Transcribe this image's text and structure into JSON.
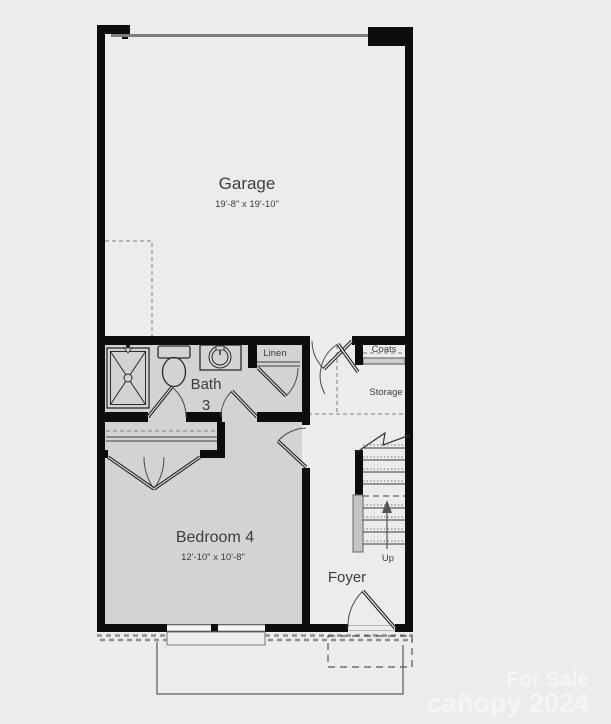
{
  "plan_title": "First floor plan",
  "colors": {
    "background": "#ececec",
    "wall": "#0d0d0d",
    "floor_gray": "#d3d3d3",
    "garage_door_line": "#7d7d7d",
    "label_text": "#3d3d3d",
    "watermark_text": "#f5f5f5"
  },
  "rooms": {
    "garage": {
      "name": "Garage",
      "dims": "19'-8\" x 19'-10\""
    },
    "bath": {
      "name_line1": "Bath",
      "name_line2": "3"
    },
    "bedroom": {
      "name": "Bedroom 4",
      "dims": "12'-10\" x 10'-8\""
    },
    "foyer": {
      "name": "Foyer"
    },
    "linen": {
      "name": "Linen"
    },
    "coats": {
      "name": "Coats"
    },
    "storage": {
      "name": "Storage"
    }
  },
  "stairs": {
    "direction_label": "Up"
  },
  "watermark": {
    "line1": "For Sale",
    "line2": "cañopy 2024"
  }
}
